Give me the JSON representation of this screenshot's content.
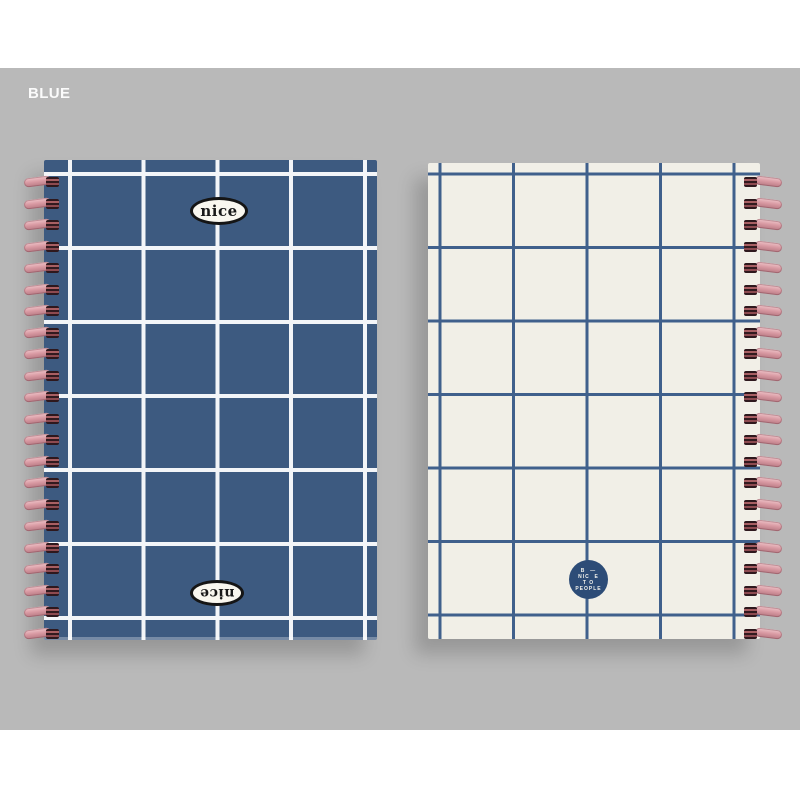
{
  "scene": {
    "page_background": "#ffffff",
    "backdrop_color": "#b9b9b9"
  },
  "swatch_label": {
    "text": "BLUE",
    "color": "#fbfbfb"
  },
  "left_notebook": {
    "description": "front cover, blue with white windowpane grid, wire binding on left",
    "cover_color": "#3d5a80",
    "grid_line_color": "#f3f5f8",
    "top_badge_text": "nice",
    "bottom_badge_text": "nice",
    "coil_color": "#d99aa3",
    "coil_count": 22
  },
  "right_notebook": {
    "description": "back cover, cream with blue windowpane grid, wire binding on right",
    "cover_color": "#f1efe7",
    "grid_line_color": "#40608c",
    "logo_badge": {
      "background": "#2d4c77",
      "lines": [
        "B  —",
        "NIC  E",
        "T O",
        "PEOPLE"
      ]
    },
    "coil_count": 22
  }
}
